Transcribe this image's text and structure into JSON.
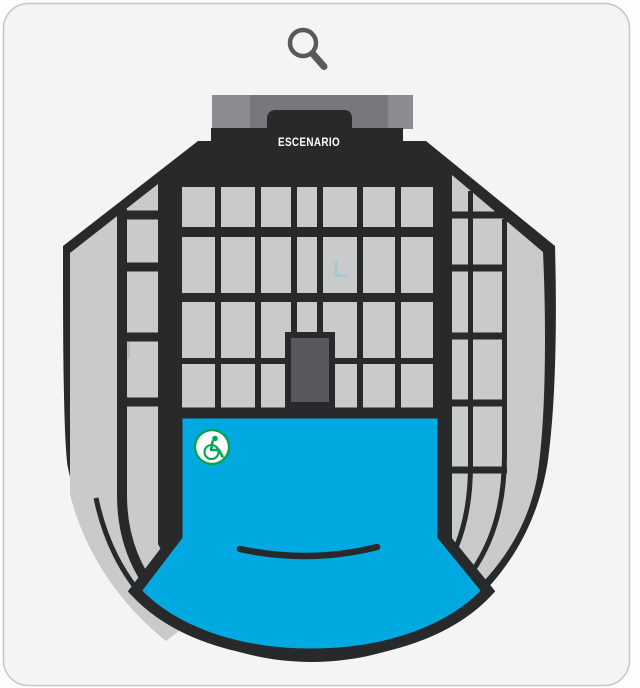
{
  "card": {
    "background": "#f4f4f5",
    "border": "#c6c6c6",
    "page_background": "#fdfdfd"
  },
  "toolbar": {
    "zoom_icon": "magnifier",
    "zoom_icon_color": "#58595b"
  },
  "venue_map": {
    "outline_color": "#27292b",
    "seat_block_color": "#c9caca",
    "stage": {
      "label": "ESCENARIO",
      "label_color": "#ffffff",
      "bar_side_color": "#8a8c8f",
      "bar_center_color": "#76787b"
    },
    "booth_color": "#58595c",
    "floor_section": {
      "color": "#00a9e0"
    },
    "labels": {
      "l": "L",
      "l_color": "#9ccbd4",
      "i": "I",
      "i_color": "#aeb3b5"
    },
    "accessible_icon": {
      "name": "wheelchair",
      "color": "#00a651",
      "background": "#ffffff"
    }
  }
}
